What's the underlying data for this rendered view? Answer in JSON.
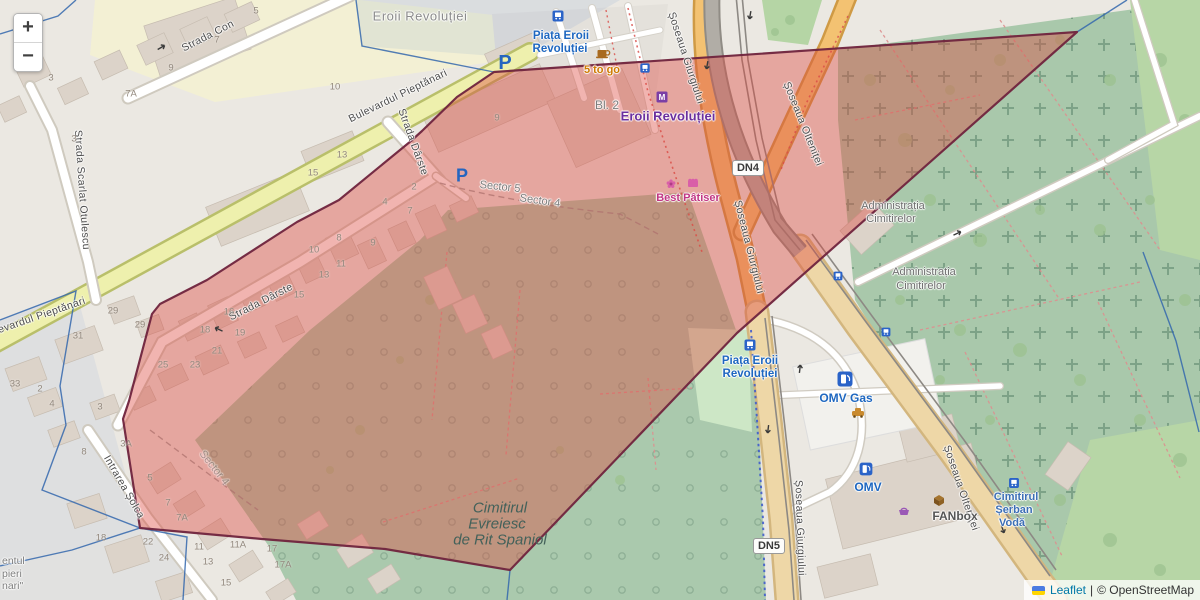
{
  "title": "Leaflet map — Piața Eroii Revoluției / Cimitirul Evreiesc de Rit Spaniol, Bucharest",
  "controls": {
    "zoom_in": "+",
    "zoom_out": "−"
  },
  "attribution": {
    "leaflet": "Leaflet",
    "separator": "|",
    "osm": "© OpenStreetMap"
  },
  "road_badges": [
    {
      "text": "DN4",
      "x": 748,
      "y": 168
    },
    {
      "text": "DN5",
      "x": 769,
      "y": 546
    }
  ],
  "colors": {
    "red_overlay_fill": "rgba(221,72,62,0.42)",
    "red_overlay_stroke": "#72263f",
    "boundary_blue": "#3467ad",
    "link_blue": "#0078A8",
    "poi_blue": "#1e67c0",
    "metro_purple": "#6b2f9e",
    "magenta": "#c13584",
    "orange_text": "#cf7a00",
    "cemetery_green": "#aac9ad",
    "road_orange": "#f3c272",
    "road_tan": "#eed7a7",
    "road_yellow": "#eef0ad"
  },
  "labels": [
    {
      "t": "Strada Con",
      "x": 208,
      "y": 36,
      "r": -27,
      "c": "st"
    },
    {
      "t": "Strada Scarlat Otulescu",
      "x": 82,
      "y": 190,
      "r": 86,
      "c": "st"
    },
    {
      "t": "Bulevardul Pieptănari",
      "x": 398,
      "y": 96,
      "r": -26,
      "c": "st"
    },
    {
      "t": "Bulevardul Pieptănari",
      "x": 34,
      "y": 318,
      "r": -19,
      "c": "st"
    },
    {
      "t": "Strada Dârste",
      "x": 413,
      "y": 142,
      "r": 70,
      "c": "st"
    },
    {
      "t": "Strada Dârste",
      "x": 261,
      "y": 302,
      "r": -27,
      "c": "st"
    },
    {
      "t": "Intrarea Șolca",
      "x": 124,
      "y": 487,
      "r": 60,
      "c": "st"
    },
    {
      "t": "Șoseaua Giurgiului",
      "x": 686,
      "y": 58,
      "r": 72,
      "c": "st"
    },
    {
      "t": "Șoseaua Giurgiului",
      "x": 749,
      "y": 247,
      "r": 76,
      "c": "st"
    },
    {
      "t": "Șoseaua Giurgiului",
      "x": 800,
      "y": 528,
      "r": 88,
      "c": "st"
    },
    {
      "t": "Șoseaua Olteniței",
      "x": 803,
      "y": 124,
      "r": 68,
      "c": "st"
    },
    {
      "t": "Șoseaua Olteniței",
      "x": 961,
      "y": 488,
      "r": 71,
      "c": "st"
    },
    {
      "t": "Eroii Revoluției",
      "x": 420,
      "y": 16,
      "r": 0,
      "c": "area"
    },
    {
      "t": "Sector 5",
      "x": 500,
      "y": 187,
      "r": 6,
      "c": "sector"
    },
    {
      "t": "Sector 4",
      "x": 540,
      "y": 201,
      "r": 8,
      "c": "sector"
    },
    {
      "t": "Sector 4",
      "x": 214,
      "y": 468,
      "r": 52,
      "c": "sector faint"
    },
    {
      "t": "Administrația",
      "x": 893,
      "y": 206,
      "r": 0,
      "c": "admin"
    },
    {
      "t": "Cimitirelor",
      "x": 891,
      "y": 219,
      "r": 0,
      "c": "admin"
    },
    {
      "t": "Administrația",
      "x": 924,
      "y": 272,
      "r": 0,
      "c": "admin"
    },
    {
      "t": "Cimitirelor",
      "x": 921,
      "y": 286,
      "r": 0,
      "c": "admin"
    },
    {
      "t": "Cimitirul",
      "x": 500,
      "y": 508,
      "r": 0,
      "c": "cem"
    },
    {
      "t": "Evreiesc",
      "x": 497,
      "y": 524,
      "r": 0,
      "c": "cem"
    },
    {
      "t": "de Rit Spaniol",
      "x": 500,
      "y": 540,
      "r": 0,
      "c": "cem"
    },
    {
      "t": "entul",
      "x": 2,
      "y": 561,
      "r": 0,
      "c": "frag"
    },
    {
      "t": "pieri",
      "x": 2,
      "y": 574,
      "r": 0,
      "c": "frag"
    },
    {
      "t": "nari\"",
      "x": 2,
      "y": 586,
      "r": 0,
      "c": "frag"
    },
    {
      "t": "Piața Eroii",
      "x": 561,
      "y": 36,
      "r": 0,
      "c": "poib"
    },
    {
      "t": "Revoluției",
      "x": 560,
      "y": 49,
      "r": 0,
      "c": "poib"
    },
    {
      "t": "5 to go",
      "x": 602,
      "y": 70,
      "r": 0,
      "c": "poio"
    },
    {
      "t": "Bl. 2",
      "x": 607,
      "y": 105,
      "r": 0,
      "c": "gray"
    },
    {
      "t": "Eroii Revoluției",
      "x": 668,
      "y": 116,
      "r": 0,
      "c": "metro"
    },
    {
      "t": "Best Pâtiser",
      "x": 688,
      "y": 198,
      "r": 0,
      "c": "mag"
    },
    {
      "t": "Piața Eroii",
      "x": 750,
      "y": 361,
      "r": 0,
      "c": "poib"
    },
    {
      "t": "Revoluției",
      "x": 750,
      "y": 374,
      "r": 0,
      "c": "poib"
    },
    {
      "t": "OMV Gas",
      "x": 846,
      "y": 398,
      "r": 0,
      "c": "poib2"
    },
    {
      "t": "OMV",
      "x": 868,
      "y": 487,
      "r": 0,
      "c": "poib2"
    },
    {
      "t": "FANbox",
      "x": 955,
      "y": 516,
      "r": 0,
      "c": "fanbox"
    },
    {
      "t": "Cimitirul",
      "x": 1016,
      "y": 497,
      "r": 0,
      "c": "cemblue"
    },
    {
      "t": "Șerban",
      "x": 1014,
      "y": 510,
      "r": 0,
      "c": "cemblue"
    },
    {
      "t": "Vodă",
      "x": 1012,
      "y": 523,
      "r": 0,
      "c": "cemblue"
    }
  ],
  "house_numbers": [
    {
      "t": "3",
      "x": 51,
      "y": 78
    },
    {
      "t": "9",
      "x": 171,
      "y": 68
    },
    {
      "t": "7",
      "x": 217,
      "y": 40
    },
    {
      "t": "5",
      "x": 256,
      "y": 11
    },
    {
      "t": "7A",
      "x": 131,
      "y": 94
    },
    {
      "t": "3",
      "x": 74,
      "y": 139
    },
    {
      "t": "10",
      "x": 335,
      "y": 87
    },
    {
      "t": "31",
      "x": 78,
      "y": 336
    },
    {
      "t": "29",
      "x": 113,
      "y": 311
    },
    {
      "t": "29",
      "x": 140,
      "y": 325
    },
    {
      "t": "33",
      "x": 15,
      "y": 384
    },
    {
      "t": "2",
      "x": 40,
      "y": 389
    },
    {
      "t": "4",
      "x": 52,
      "y": 404
    },
    {
      "t": "3",
      "x": 100,
      "y": 407
    },
    {
      "t": "8",
      "x": 84,
      "y": 452
    },
    {
      "t": "3A",
      "x": 126,
      "y": 444
    },
    {
      "t": "16",
      "x": 229,
      "y": 312
    },
    {
      "t": "18",
      "x": 205,
      "y": 330
    },
    {
      "t": "19",
      "x": 240,
      "y": 333
    },
    {
      "t": "21",
      "x": 217,
      "y": 351
    },
    {
      "t": "23",
      "x": 195,
      "y": 365
    },
    {
      "t": "25",
      "x": 163,
      "y": 365
    },
    {
      "t": "15",
      "x": 299,
      "y": 295
    },
    {
      "t": "2",
      "x": 414,
      "y": 187
    },
    {
      "t": "4",
      "x": 385,
      "y": 202
    },
    {
      "t": "7",
      "x": 410,
      "y": 211
    },
    {
      "t": "8",
      "x": 339,
      "y": 238
    },
    {
      "t": "9",
      "x": 373,
      "y": 243
    },
    {
      "t": "10",
      "x": 314,
      "y": 250
    },
    {
      "t": "11",
      "x": 341,
      "y": 264
    },
    {
      "t": "13",
      "x": 324,
      "y": 275
    },
    {
      "t": "13",
      "x": 342,
      "y": 155
    },
    {
      "t": "15",
      "x": 313,
      "y": 173
    },
    {
      "t": "9",
      "x": 497,
      "y": 118
    },
    {
      "t": "5",
      "x": 150,
      "y": 478
    },
    {
      "t": "7",
      "x": 168,
      "y": 503
    },
    {
      "t": "7A",
      "x": 182,
      "y": 518
    },
    {
      "t": "22",
      "x": 148,
      "y": 542
    },
    {
      "t": "24",
      "x": 164,
      "y": 558
    },
    {
      "t": "11",
      "x": 199,
      "y": 547
    },
    {
      "t": "11A",
      "x": 238,
      "y": 545
    },
    {
      "t": "13",
      "x": 208,
      "y": 562
    },
    {
      "t": "15",
      "x": 226,
      "y": 583
    },
    {
      "t": "17",
      "x": 272,
      "y": 549
    },
    {
      "t": "17A",
      "x": 283,
      "y": 565
    },
    {
      "t": "18",
      "x": 101,
      "y": 538
    }
  ],
  "icons": [
    {
      "n": "bus-stop-icon",
      "type": "bus",
      "x": 558,
      "y": 16,
      "s": 1
    },
    {
      "n": "bus-stop-icon",
      "type": "bus",
      "x": 645,
      "y": 68,
      "s": 0.85
    },
    {
      "n": "bus-stop-icon",
      "type": "bus",
      "x": 750,
      "y": 345,
      "s": 1
    },
    {
      "n": "bus-stop-icon",
      "type": "bus",
      "x": 1014,
      "y": 483,
      "s": 0.9
    },
    {
      "n": "bus-stop-icon",
      "type": "bus",
      "x": 838,
      "y": 276,
      "s": 0.8
    },
    {
      "n": "bus-stop-icon",
      "type": "bus",
      "x": 886,
      "y": 332,
      "s": 0.8
    },
    {
      "n": "parking-icon",
      "type": "parking",
      "x": 505,
      "y": 62,
      "s": 1
    },
    {
      "n": "parking-icon",
      "type": "parking",
      "x": 462,
      "y": 175,
      "s": 0.9
    },
    {
      "n": "metro-icon",
      "type": "metro",
      "x": 662,
      "y": 97,
      "s": 1
    },
    {
      "n": "fuel-station-icon",
      "type": "fuel",
      "x": 845,
      "y": 379,
      "s": 1
    },
    {
      "n": "fuel-station-icon",
      "type": "fuel",
      "x": 866,
      "y": 469,
      "s": 0.85
    },
    {
      "n": "coffee-icon",
      "type": "coffee",
      "x": 602,
      "y": 53,
      "s": 1
    },
    {
      "n": "flower-shop-icon",
      "type": "flower",
      "x": 671,
      "y": 184,
      "s": 1
    },
    {
      "n": "bakery-icon",
      "type": "shop",
      "x": 693,
      "y": 183,
      "s": 1
    },
    {
      "n": "parcel-box-icon",
      "type": "box",
      "x": 939,
      "y": 500,
      "s": 1
    },
    {
      "n": "basket-icon",
      "type": "basket",
      "x": 904,
      "y": 511,
      "s": 1
    },
    {
      "n": "car-wash-icon",
      "type": "car",
      "x": 858,
      "y": 413,
      "s": 1
    },
    {
      "n": "oneway-arrow-icon",
      "type": "arrow",
      "x": 750,
      "y": 16,
      "s": 1,
      "r": 100
    },
    {
      "n": "oneway-arrow-icon",
      "type": "arrow",
      "x": 707,
      "y": 66,
      "s": 1,
      "r": 100
    },
    {
      "n": "oneway-arrow-icon",
      "type": "arrow",
      "x": 218,
      "y": 329,
      "s": 1,
      "r": -155
    },
    {
      "n": "oneway-arrow-icon",
      "type": "arrow",
      "x": 162,
      "y": 47,
      "s": 1,
      "r": -30
    },
    {
      "n": "oneway-arrow-icon",
      "type": "arrow",
      "x": 800,
      "y": 368,
      "s": 1,
      "r": -83
    },
    {
      "n": "oneway-arrow-icon",
      "type": "arrow",
      "x": 768,
      "y": 430,
      "s": 1,
      "r": 97
    },
    {
      "n": "oneway-arrow-icon",
      "type": "arrow",
      "x": 1003,
      "y": 530,
      "s": 1,
      "r": 70
    },
    {
      "n": "oneway-arrow-icon",
      "type": "arrow",
      "x": 958,
      "y": 233,
      "s": 1,
      "r": -25
    }
  ]
}
